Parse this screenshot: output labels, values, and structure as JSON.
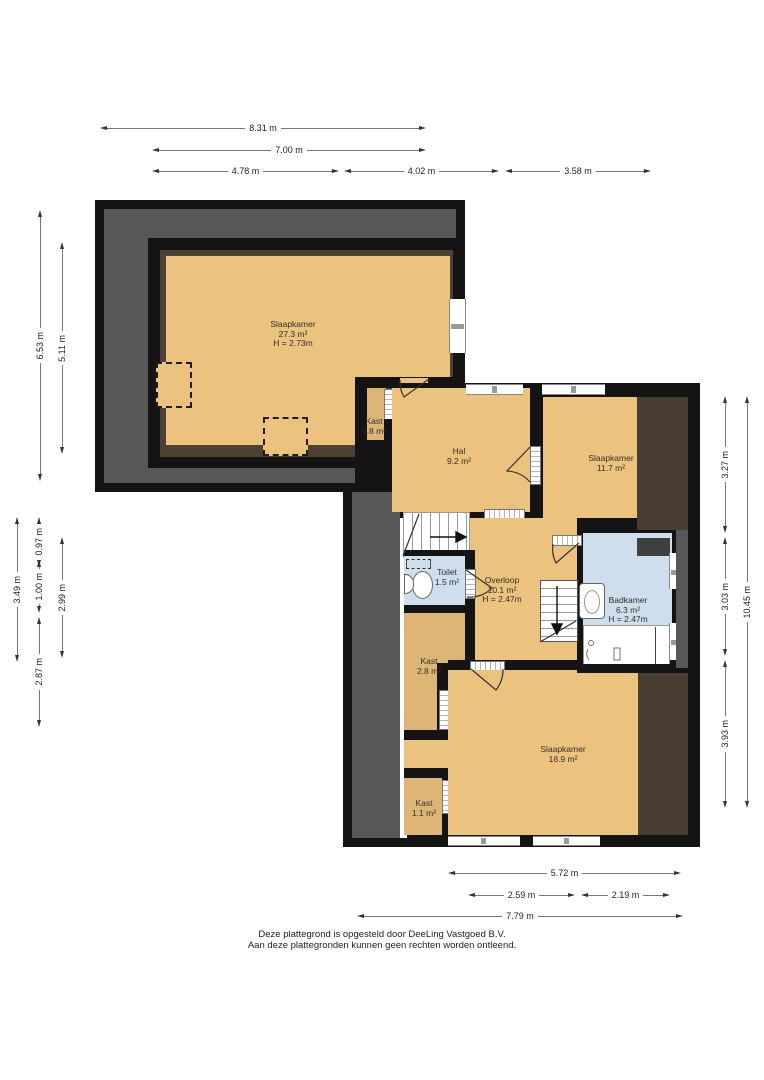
{
  "footer": {
    "line1": "Deze plattegrond is opgesteld door DeeLing Vastgoed B.V.",
    "line2": "Aan deze plattegronden kunnen geen rechten worden ontleend."
  },
  "rooms": [
    {
      "id": "slaapkamer-27",
      "name": "Slaapkamer",
      "area": "27.3 m²",
      "height": "H = 2.73m",
      "x": 293,
      "y": 320
    },
    {
      "id": "kast-08",
      "name": "Kast",
      "area": "0.8 m²",
      "height": "",
      "x": 374,
      "y": 417
    },
    {
      "id": "hal",
      "name": "Hal",
      "area": "9.2 m²",
      "height": "",
      "x": 459,
      "y": 447
    },
    {
      "id": "slaapkamer-117",
      "name": "Slaapkamer",
      "area": "11.7 m²",
      "height": "",
      "x": 611,
      "y": 454
    },
    {
      "id": "toilet",
      "name": "Toilet",
      "area": "1.5 m²",
      "height": "",
      "x": 447,
      "y": 568
    },
    {
      "id": "overloop",
      "name": "Overloop",
      "area": "10.1 m²",
      "height": "H = 2.47m",
      "x": 502,
      "y": 576
    },
    {
      "id": "badkamer",
      "name": "Badkamer",
      "area": "6.3 m²",
      "height": "H = 2.47m",
      "x": 628,
      "y": 596
    },
    {
      "id": "kast-28",
      "name": "Kast",
      "area": "2.8 m²",
      "height": "",
      "x": 429,
      "y": 657
    },
    {
      "id": "slaapkamer-189",
      "name": "Slaapkamer",
      "area": "18.9 m²",
      "height": "",
      "x": 563,
      "y": 745
    },
    {
      "id": "kast-11",
      "name": "Kast",
      "area": "1.1 m²",
      "height": "",
      "x": 424,
      "y": 799
    }
  ],
  "dimensions": [
    {
      "label": "8.31 m",
      "dir": "h",
      "x": 100,
      "y": 128,
      "len": 326
    },
    {
      "label": "7.00 m",
      "dir": "h",
      "x": 152,
      "y": 150,
      "len": 274
    },
    {
      "label": "4.78 m",
      "dir": "h",
      "x": 152,
      "y": 171,
      "len": 187
    },
    {
      "label": "4.02 m",
      "dir": "h",
      "x": 344,
      "y": 171,
      "len": 155
    },
    {
      "label": "3.58 m",
      "dir": "h",
      "x": 505,
      "y": 171,
      "len": 146
    },
    {
      "label": "6.53 m",
      "dir": "v",
      "x": 40,
      "y": 210,
      "len": 271
    },
    {
      "label": "5.11 m",
      "dir": "v",
      "x": 62,
      "y": 242,
      "len": 212
    },
    {
      "label": "3.49 m",
      "dir": "v",
      "x": 17,
      "y": 517,
      "len": 145
    },
    {
      "label": "0.97 m",
      "dir": "v",
      "x": 39,
      "y": 517,
      "len": 39
    },
    {
      "label": "1.00 m",
      "dir": "v",
      "x": 39,
      "y": 560,
      "len": 53
    },
    {
      "label": "2.87 m",
      "dir": "v",
      "x": 39,
      "y": 617,
      "len": 110
    },
    {
      "label": "2.99 m",
      "dir": "v",
      "x": 62,
      "y": 537,
      "len": 121
    },
    {
      "label": "3.27 m",
      "dir": "v",
      "x": 725,
      "y": 396,
      "len": 137
    },
    {
      "label": "3.03 m",
      "dir": "v",
      "x": 725,
      "y": 537,
      "len": 119
    },
    {
      "label": "3.93 m",
      "dir": "v",
      "x": 725,
      "y": 660,
      "len": 148
    },
    {
      "label": "10.45 m",
      "dir": "v",
      "x": 747,
      "y": 396,
      "len": 412
    },
    {
      "label": "5.72 m",
      "dir": "h",
      "x": 448,
      "y": 873,
      "len": 233
    },
    {
      "label": "2.59 m",
      "dir": "h",
      "x": 468,
      "y": 895,
      "len": 107
    },
    {
      "label": "2.19 m",
      "dir": "h",
      "x": 581,
      "y": 895,
      "len": 89
    },
    {
      "label": "7.79 m",
      "dir": "h",
      "x": 357,
      "y": 916,
      "len": 326
    }
  ],
  "colors": {
    "wall": "#141414",
    "floor": "#ecc27f",
    "closet": "#dcb577",
    "wet_room": "#cfdeed",
    "low_ceiling_gray": "#575757",
    "low_ceiling_brown": "#483e31"
  }
}
